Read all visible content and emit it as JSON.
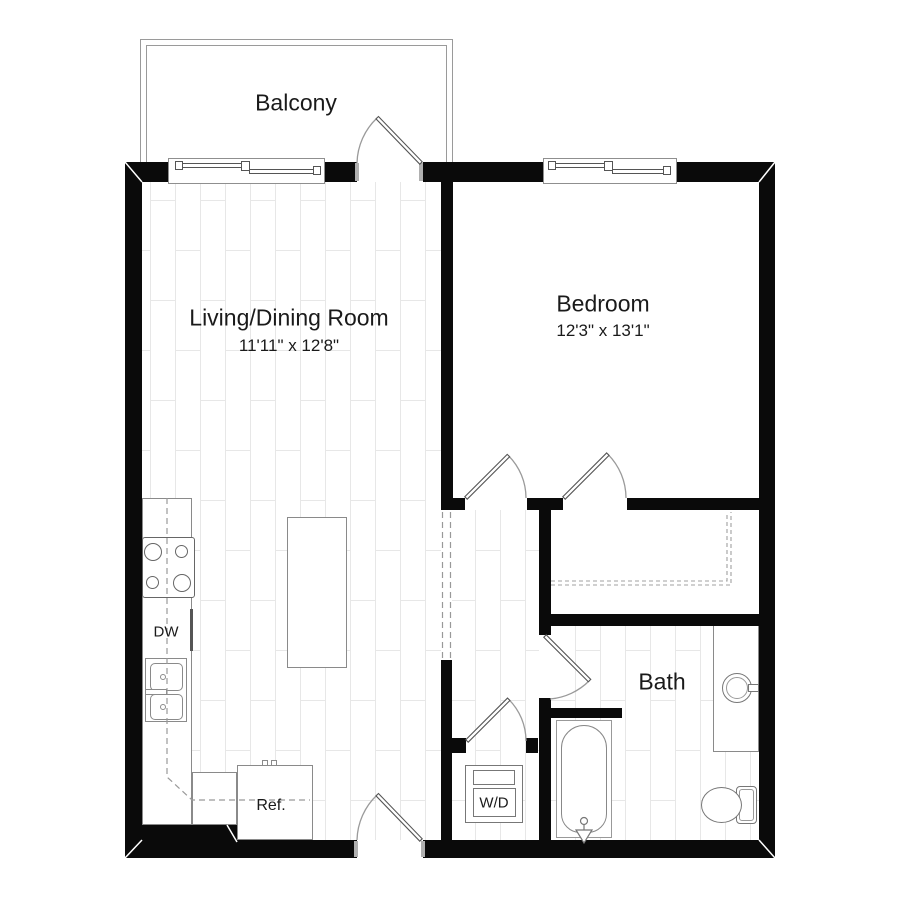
{
  "plan": {
    "title": "One-bedroom apartment floor plan",
    "rooms": {
      "balcony": {
        "label": "Balcony"
      },
      "living_dining": {
        "label": "Living/Dining Room",
        "dimensions": "11'11\" x 12'8\""
      },
      "bedroom": {
        "label": "Bedroom",
        "dimensions": "12'3\" x 13'1\""
      },
      "bath": {
        "label": "Bath"
      }
    },
    "appliances": {
      "dishwasher": {
        "label": "DW"
      },
      "washer_dryer": {
        "label": "W/D"
      },
      "refrigerator": {
        "label": "Ref."
      }
    },
    "colors": {
      "wall": "#0a0a0a",
      "fixture_line": "#8a8a8a",
      "floor_line": "#e7e7e7",
      "text": "#1a1a1a",
      "background": "#ffffff"
    }
  }
}
